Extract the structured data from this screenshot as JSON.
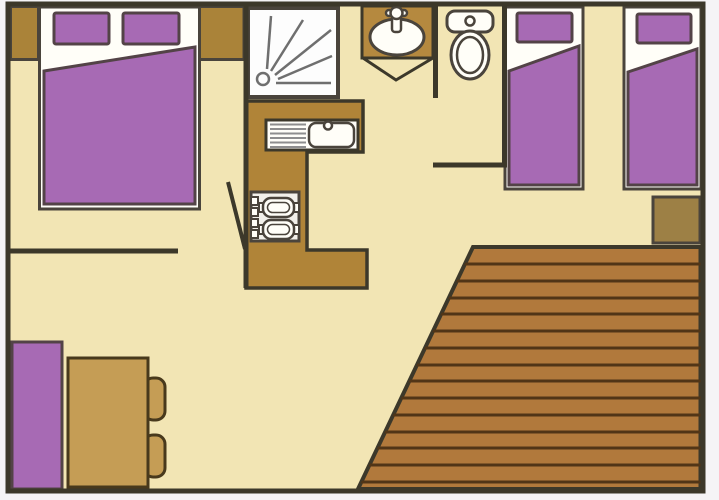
{
  "diagram": {
    "kind": "floor-plan",
    "rooms": [
      "double-bedroom",
      "shower-room",
      "wc",
      "twin-bedroom",
      "kitchen",
      "living-dining-area",
      "deck-terrace"
    ],
    "fixtures": [
      "double-bed",
      "pillow",
      "bedside-cabinet",
      "single-bed",
      "single-bed",
      "side-table",
      "shower-tray",
      "washbasin-vanity",
      "tap",
      "toilet",
      "kitchen-counter",
      "kitchen-sink",
      "draining-board",
      "stove-hob",
      "dining-table",
      "bench-seat",
      "chair",
      "door-swing",
      "folding-door",
      "deck-planks"
    ]
  },
  "colors": {
    "outside": "#f5f4f6",
    "wall": "#3c382a",
    "floor": "#f2e5b4",
    "purple": "#a76ab4",
    "purple_outline": "#534347",
    "white_fixture": "#fffef8",
    "shower_white": "#fdfdfd",
    "fixture_outline": "#4a443c",
    "cabinet": "#aa8339",
    "counter": "#b08438",
    "vanity": "#b5893f",
    "table": "#c59d55",
    "table_outline": "#48391c",
    "side_table": "#9d8045",
    "deck": "#b1793c",
    "deck_line": "#513517",
    "stove_face": "#f2f0ea",
    "shower_line": "#6f6f6f",
    "drainer_line": "#8e8e8e"
  }
}
